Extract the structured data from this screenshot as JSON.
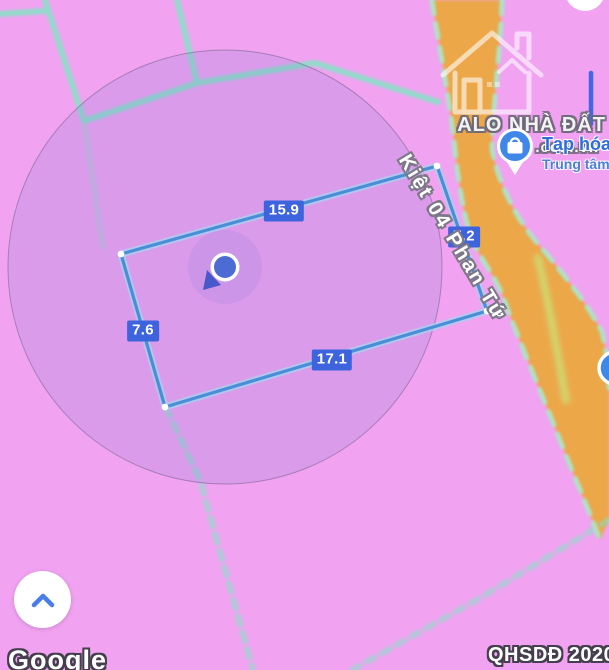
{
  "colors": {
    "map_pink": "#f1a3f1",
    "selection_fill": "rgba(108,116,208,0.16)",
    "selection_border": "rgba(88,82,118,0.45)",
    "parcel_teal": "#82e4c4",
    "road_orange": "#eca74a",
    "road_edge_mint": "#a5ecca",
    "road_stripe_green": "#cedd72",
    "measure_line": "#4a8fd6",
    "measure_glow": "#a6d2f0",
    "measure_label_bg": "#3d63dd",
    "poi_blue": "#3f87e8",
    "poi_text": "#2e6ed6",
    "poi_text_sub": "#4a7fd8",
    "chevron_blue": "#4a7de8",
    "location_dot": "#4c6cd3",
    "path_blue": "#3e68e8"
  },
  "map": {
    "street_name": "Kiệt 04 Phan Tứ",
    "measurements": {
      "top": "15.9",
      "right": "7.2",
      "left": "7.6",
      "bottom": "17.1"
    },
    "poi": {
      "name": "Tạp hóa",
      "subtitle": "Trung tâm"
    },
    "watermark": {
      "brand": "ALO NHÀ ĐẤT",
      "domain": ".com.vn"
    }
  },
  "footer": {
    "attribution": "Google",
    "overlay_code": "QHSDĐ 2020"
  }
}
